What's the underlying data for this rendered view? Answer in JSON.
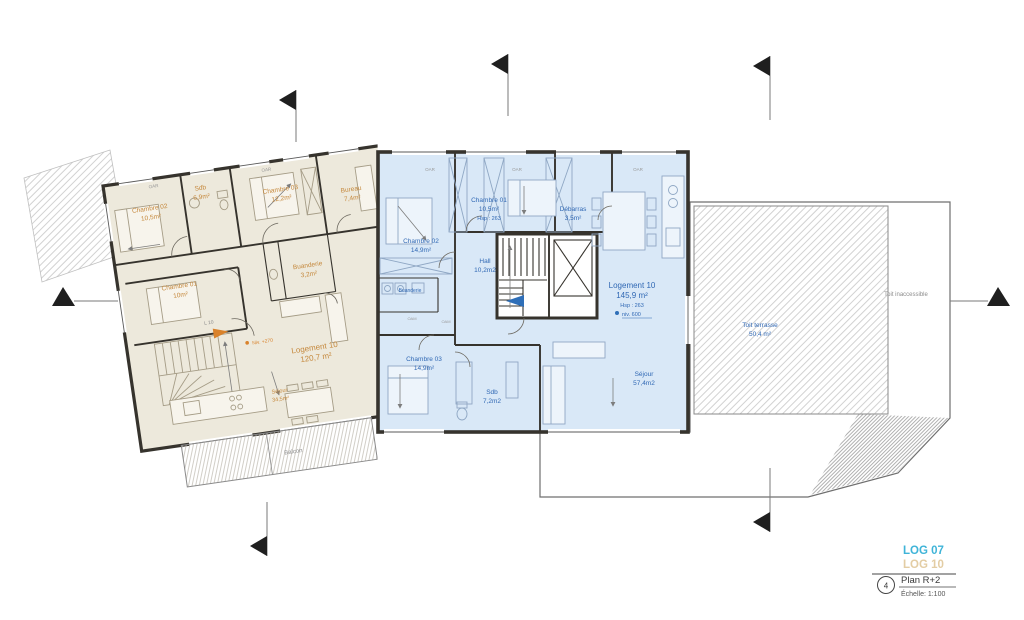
{
  "legend": {
    "log07_label": "LOG 07",
    "log10_label": "LOG 10",
    "log07_color": "#3fb4d8",
    "log10_color": "#e3cda4",
    "sheet_number": "4",
    "plan_title": "Plan R+2",
    "scale_label": "Échelle: 1:100"
  },
  "unit_left": {
    "door_tag": "L 10",
    "name": "Logement 10",
    "area": "120,7 m²",
    "level_note": "Niv. +270",
    "balcony_label": "Balcon",
    "rooms": {
      "chambre02": {
        "name": "Chambre 02",
        "area": "10,5m²"
      },
      "sdb": {
        "name": "Sdb",
        "area": "6,9m²"
      },
      "chambre03": {
        "name": "Chambre 03",
        "area": "12,2m²"
      },
      "bureau": {
        "name": "Bureau",
        "area": "7,4m²"
      },
      "chambre01": {
        "name": "Chambre 01",
        "area": "10m²"
      },
      "buanderie": {
        "name": "Buanderie",
        "area": "3,2m²"
      },
      "sejour": {
        "name": "Séjour",
        "area": "34,5m²"
      }
    }
  },
  "unit_right": {
    "name": "Logement 10",
    "area": "145,9 m²",
    "hsp": "Hsp : 263",
    "level_note": "niv. 600",
    "rooms": {
      "chambre01": {
        "name": "Chambre 01",
        "area": "10,5m²",
        "hsp": "Hsp : 263"
      },
      "chambre02": {
        "name": "Chambre 02",
        "area": "14,9m²"
      },
      "debarras": {
        "name": "Débarras",
        "area": "3,5m²"
      },
      "hall": {
        "name": "Hall",
        "area": "10,2m2"
      },
      "buanderie": {
        "name": "Buanderie"
      },
      "chambre03": {
        "name": "Chambre 03",
        "area": "14,9m²"
      },
      "sdb": {
        "name": "Sdb",
        "area": "7,2m2"
      },
      "sejour": {
        "name": "Séjour",
        "area": "57,4m2"
      }
    }
  },
  "roof": {
    "terrace_name": "Toit terrasse",
    "terrace_area": "50,4 m²",
    "inaccessible_label": "Toit inaccessible"
  },
  "tags": {
    "closet": "OAR",
    "equipment": "OAM"
  }
}
